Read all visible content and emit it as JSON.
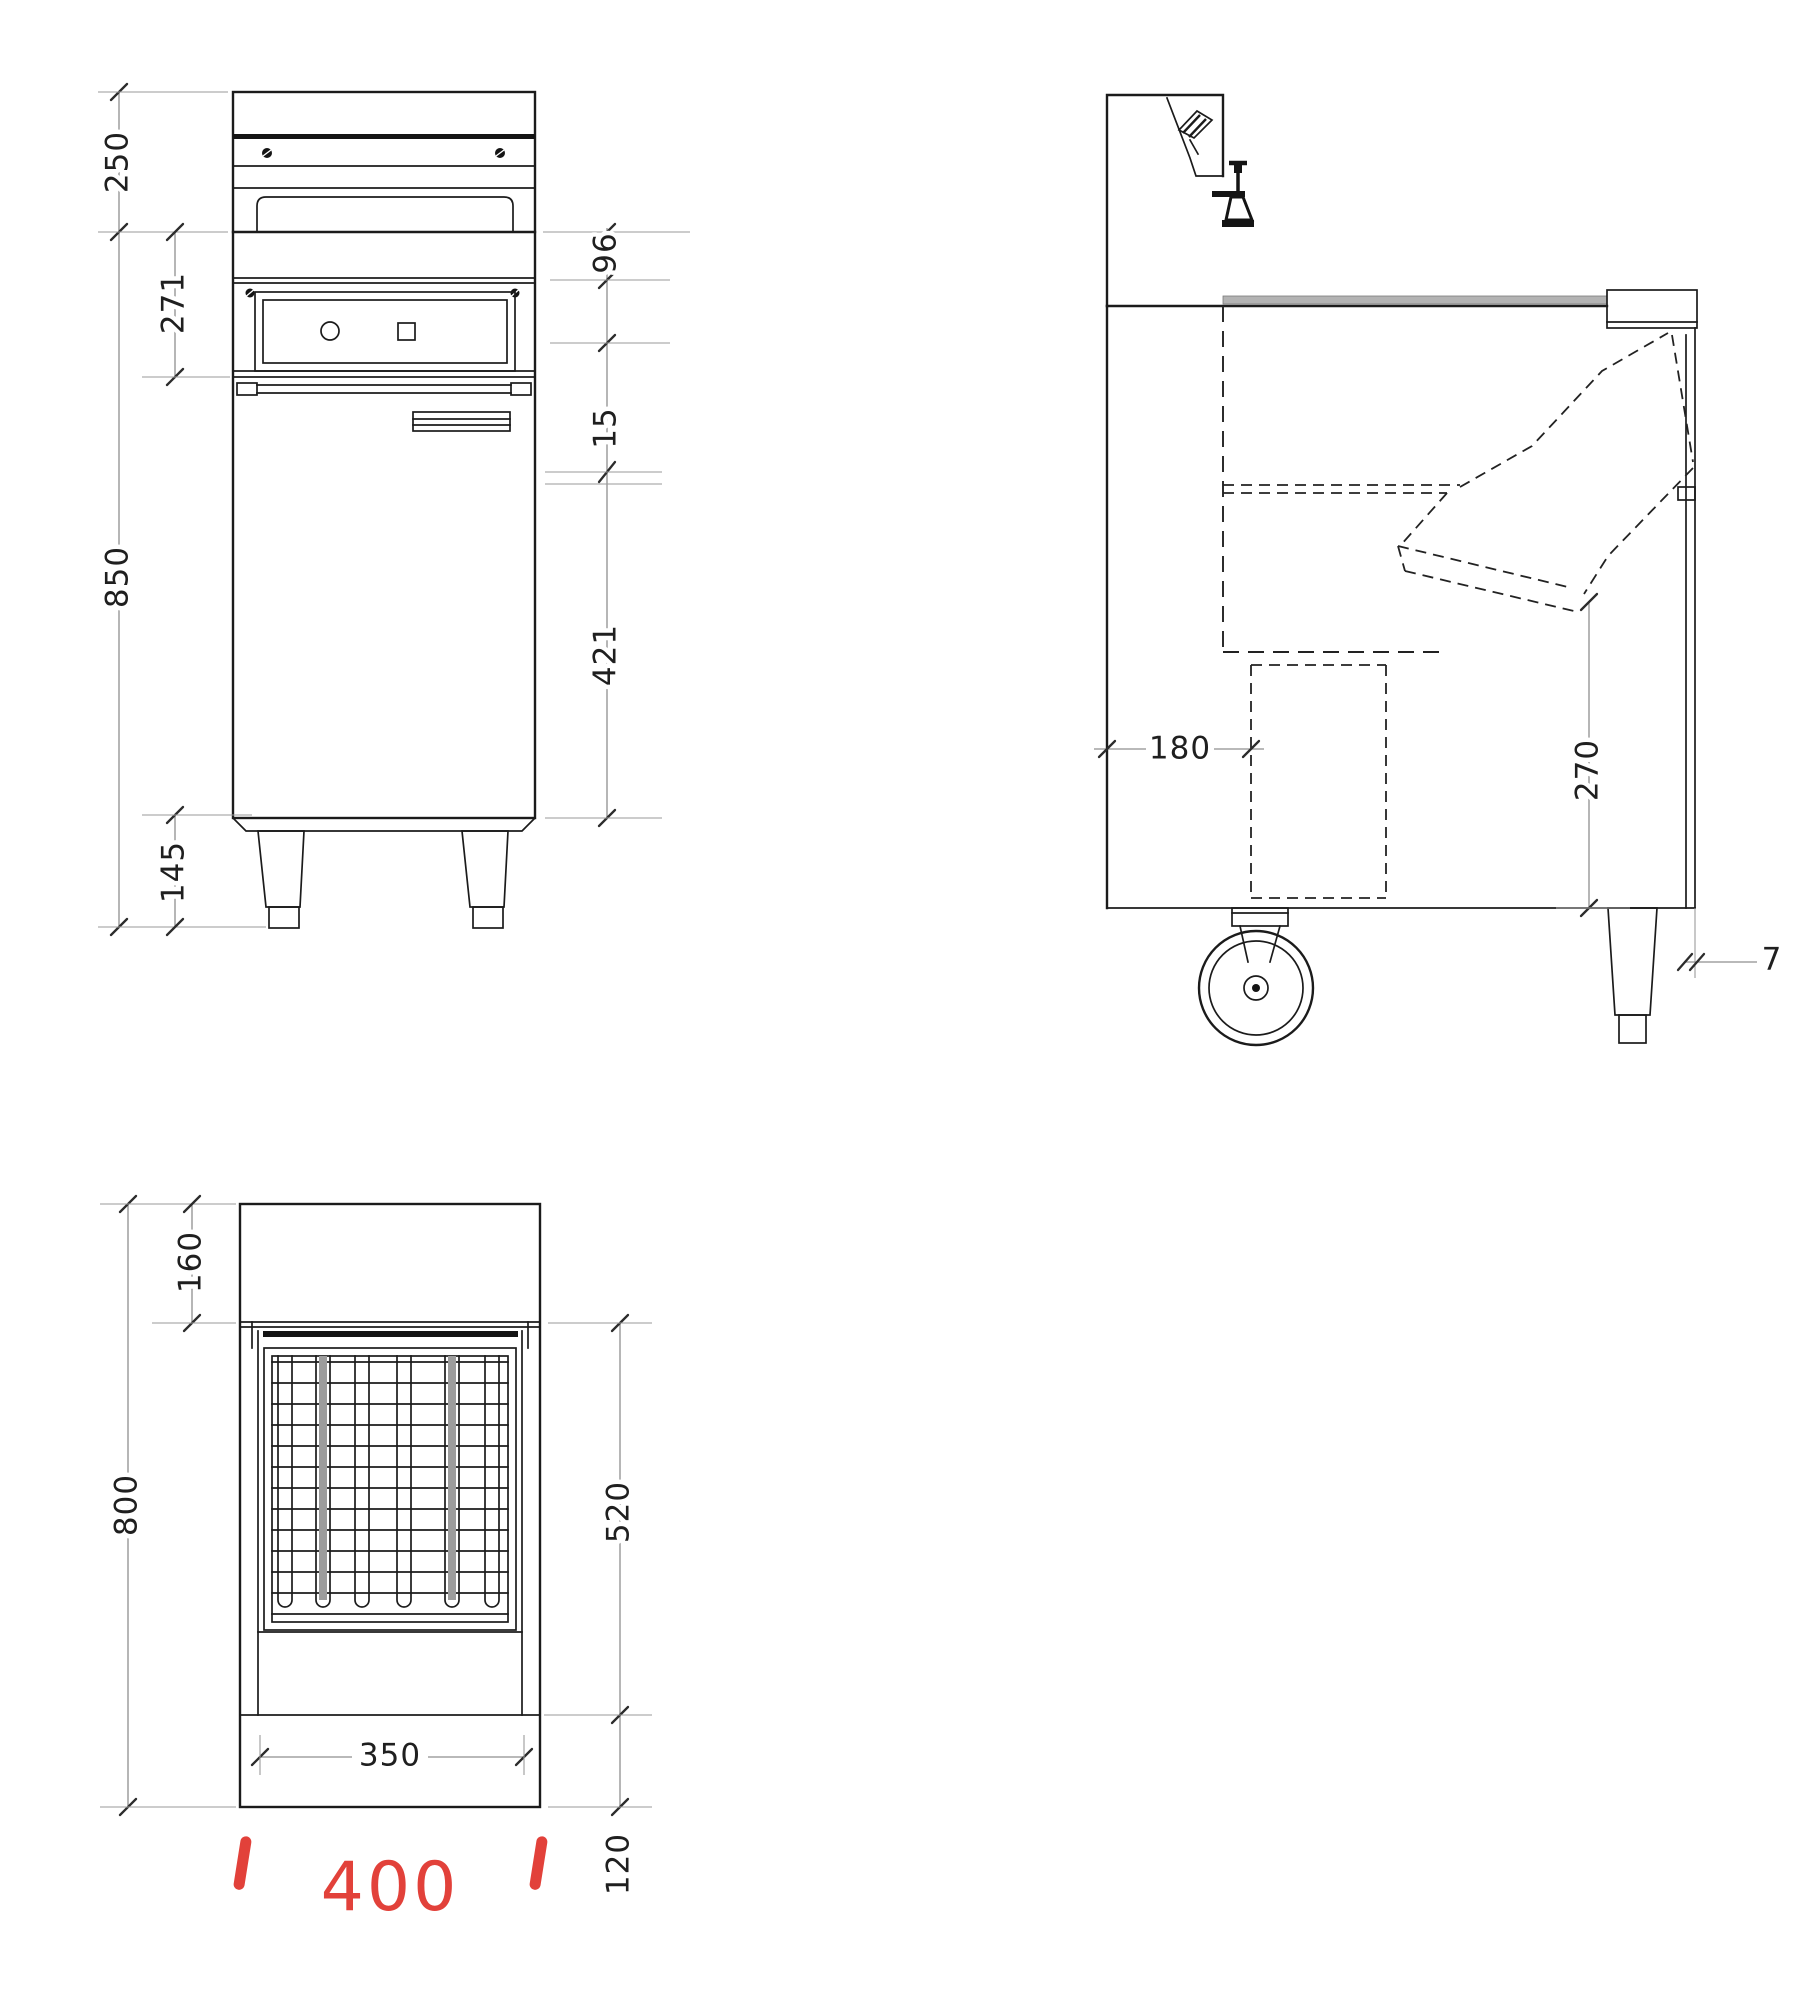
{
  "drawing": {
    "type": "technical-dimension-drawing",
    "views": [
      "front",
      "side",
      "plan"
    ],
    "dims": {
      "v250": "250",
      "v271": "271",
      "v850": "850",
      "v145": "145",
      "v96": "96",
      "v15": "15",
      "v421": "421",
      "v180": "180",
      "v270": "270",
      "v7": "7",
      "v160": "160",
      "v800": "800",
      "v520": "520",
      "v350": "350",
      "v120": "120"
    },
    "highlight": {
      "v400": "400",
      "color": "#e2413a"
    }
  }
}
